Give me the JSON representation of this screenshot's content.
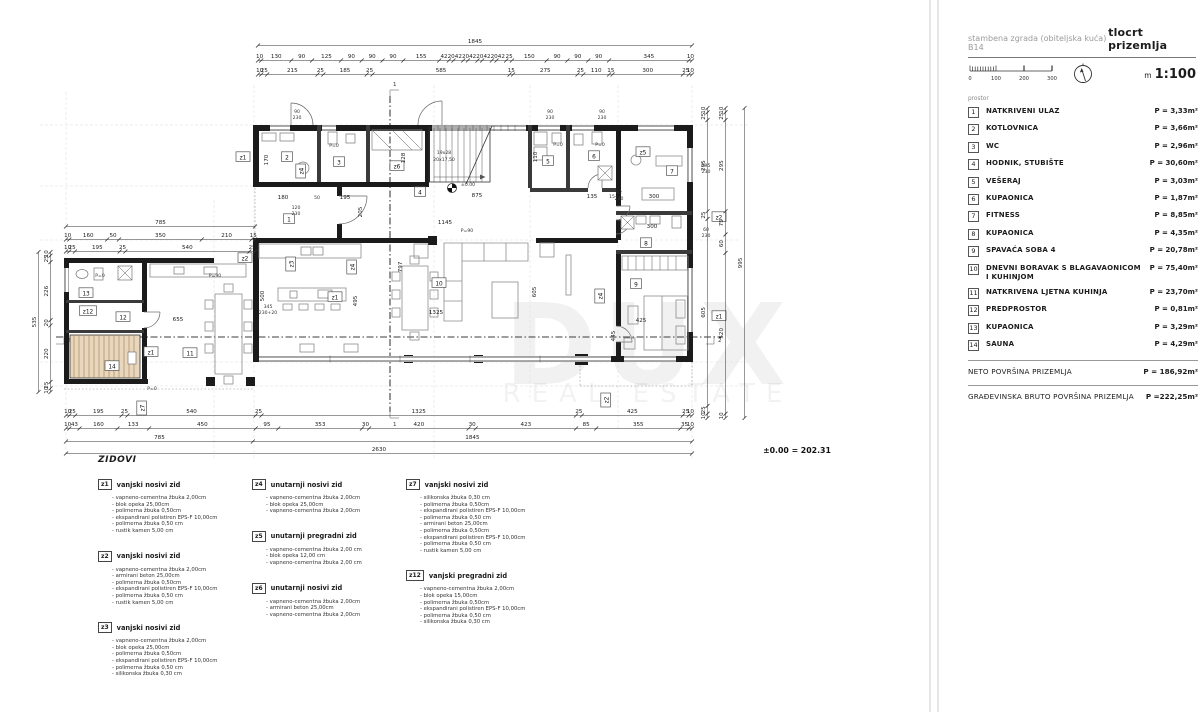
{
  "title_block": {
    "project": "stambena zgrada (obiteljska kuća) B14",
    "drawing": "tlocrt prizemlja",
    "scale_m": "m",
    "scale_value": "1:100",
    "ticks": [
      "0",
      "100",
      "200",
      "300"
    ]
  },
  "rooms": {
    "header": "prostor",
    "items": [
      {
        "num": "1",
        "name": "NATKRIVENI ULAZ",
        "area": "P = 3,33m²"
      },
      {
        "num": "2",
        "name": "KOTLOVNICA",
        "area": "P = 3,66m²"
      },
      {
        "num": "3",
        "name": "WC",
        "area": "P = 2,96m²"
      },
      {
        "num": "4",
        "name": "HODNIK, STUBIŠTE",
        "area": "P = 30,60m²"
      },
      {
        "num": "5",
        "name": "VEŠERAJ",
        "area": "P = 3,03m²"
      },
      {
        "num": "6",
        "name": "KUPAONICA",
        "area": "P = 1,87m²"
      },
      {
        "num": "7",
        "name": "FITNESS",
        "area": "P = 8,85m²"
      },
      {
        "num": "8",
        "name": "KUPAONICA",
        "area": "P = 4,35m²"
      },
      {
        "num": "9",
        "name": "SPAVAĆA SOBA 4",
        "area": "P = 20,78m²"
      },
      {
        "num": "10",
        "name": "DNEVNI BORAVAK S BLAGAVAONICOM I KUHINJOM",
        "area": "P = 75,40m²"
      },
      {
        "num": "11",
        "name": "NATKRIVENA LJETNA KUHINJA",
        "area": "P = 23,70m²"
      },
      {
        "num": "12",
        "name": "PREDPROSTOR",
        "area": "P = 0,81m²"
      },
      {
        "num": "13",
        "name": "KUPAONICA",
        "area": "P = 3,29m²"
      },
      {
        "num": "14",
        "name": "SAUNA",
        "area": "P = 4,29m²"
      }
    ],
    "neto_label": "NETO POVRŠINA PRIZEMLJA",
    "neto_area": "P = 186,92m²",
    "bruto_label": "GRAĐEVINSKA BRUTO POVRŠINA PRIZEMLJA",
    "bruto_area": "P =222,25m²"
  },
  "level_note": "±0.00 = 202.31",
  "watermark": {
    "line1": "DUX",
    "line2": "REAL ESTATE"
  },
  "walls_legend": {
    "title": "ZIDOVI",
    "items": [
      {
        "code": "z1",
        "name": "vanjski nosivi zid",
        "layers": [
          "- vapneno-cementna žbuka 2,00cm",
          "- blok opeka 25,00cm",
          "- polimerna žbuka 0,50cm",
          "- ekspandirani polistiren EPS-F 10,00cm",
          "- polimerna žbuka 0,50 cm",
          "- rustik kamen 5,00 cm"
        ]
      },
      {
        "code": "z2",
        "name": "vanjski nosivi zid",
        "layers": [
          "- vapneno-cementna žbuka 2,00cm",
          "- armirani beton 25,00cm",
          "- polimerna žbuka 0,50cm",
          "- ekspandirani polistiren EPS-F 10,00cm",
          "- polimerna žbuka 0,50 cm",
          "- rustik kamen 5,00 cm"
        ]
      },
      {
        "code": "z3",
        "name": "vanjski nosivi zid",
        "layers": [
          "- vapneno-cementna žbuka 2,00cm",
          "- blok opeka 25,00cm",
          "- polimerna žbuka 0,50cm",
          "- ekspandirani polistiren EPS-F 10,00cm",
          "- polimerna žbuka 0,50 cm",
          "- silikonska žbuka 0,30 cm"
        ]
      },
      {
        "code": "z4",
        "name": "unutarnji nosivi zid",
        "layers": [
          "- vapneno-cementna žbuka 2,00cm",
          "- blok opeka 25,00cm",
          "- vapneno-cementna žbuka 2,00cm"
        ]
      },
      {
        "code": "z5",
        "name": "unutarnji pregradni zid",
        "layers": [
          "- vapneno-cementna žbuka 2,00 cm",
          "- blok opeka 12,00 cm",
          "- vapneno-cementna žbuka 2,00 cm"
        ]
      },
      {
        "code": "z6",
        "name": "unutarnji nosivi zid",
        "layers": [
          "- vapneno-cementna žbuka 2,00cm",
          "- armirani beton 25,00cm",
          "- vapneno-cementna žbuka 2,00cm"
        ]
      },
      {
        "code": "z7",
        "name": "vanjski nosivi zid",
        "layers": [
          "- silikonska žbuka 0,30 cm",
          "- polimerna žbuka 0,50cm",
          "- ekspandirani polistiren EPS-F 10,00cm",
          "- polimerna žbuka 0,50 cm",
          "- armirani beton  25,00cm",
          "- polimerna žbuka 0,50cm",
          "- ekspandirani polistiren EPS-F 10,00cm",
          "- polimerna žbuka 0,50 cm",
          "- rustik kamen 5,00 cm"
        ]
      },
      {
        "code": "z12",
        "name": "vanjski pregradni zid",
        "layers": [
          "- vapneno-cementna žbuka 2,00cm",
          "- blok opeka 15,00cm",
          "- polimerna žbuka 0,50cm",
          "- ekspandirani polistiren EPS-F 10,00cm",
          "- polimerna žbuka 0,50 cm",
          "- silikonska žbuka 0,30 cm"
        ]
      }
    ]
  },
  "plan": {
    "section_marker": {
      "s1": "1",
      "s2": "2"
    },
    "stairs": {
      "l1": "19x28",
      "l2": "20x17,50"
    },
    "labels": {
      "d875": "875",
      "d1145": "1145",
      "d1325": "1325",
      "d655": "655",
      "d135": "135",
      "d15": "15",
      "d300": "300",
      "d180": "180",
      "d50": "50",
      "d195": "195",
      "d170": "170",
      "d128": "128",
      "d110": "110",
      "d120": "120",
      "d205": "205",
      "d230": "230",
      "d90": "90",
      "d500": "500",
      "d495": "495",
      "d797": "797",
      "d605": "605",
      "d445": "445",
      "d425": "425",
      "d345": "345",
      "d230p20": "230+20",
      "d295": "295",
      "d60": "60",
      "d92": "92",
      "p0": "P=0",
      "p90": "P=90",
      "level": "±0.00"
    },
    "dims": {
      "top_total": [
        "1845"
      ],
      "top_row_b": [
        "10",
        "130",
        "90",
        "125",
        "90",
        "90",
        "90",
        "155",
        "42",
        "20",
        "42",
        "20",
        "42",
        "20",
        "42",
        "20",
        "42",
        "25",
        "150",
        "90",
        "90",
        "90",
        "345",
        "10"
      ],
      "top_row_c": [
        "10",
        "25",
        "215",
        "25",
        "185",
        "25",
        "585",
        "15",
        "275",
        "25",
        "110",
        "15",
        "300",
        "25",
        "10"
      ],
      "wing_total": [
        "785"
      ],
      "wing_row_a": [
        "10",
        "160",
        "50",
        "350",
        "210",
        "15"
      ],
      "wing_row_b": [
        "10",
        "25",
        "195",
        "25",
        "540",
        "25"
      ],
      "left_col": [
        "10",
        "25",
        "226",
        "20",
        "220",
        "25",
        "10"
      ],
      "left_total": [
        "535"
      ],
      "right_col_1": [
        "10",
        "25",
        "295",
        "25",
        "605",
        "25",
        "10"
      ],
      "right_col_2": [
        "10",
        "25",
        "295",
        "75",
        "60",
        "520",
        "10"
      ],
      "right_total": [
        "995"
      ],
      "bottom_row_1": [
        "10",
        "25",
        "195",
        "25",
        "540",
        "25",
        "1325",
        "25",
        "425",
        "25",
        "10"
      ],
      "bottom_row_2": [
        "10",
        "43",
        "160",
        "133",
        "450",
        "95",
        "353",
        "30",
        "420",
        "30",
        "423",
        "85",
        "355",
        "35",
        "10"
      ],
      "bottom_row_3": [
        "785",
        "1845"
      ],
      "bottom_total": [
        "2630"
      ]
    }
  }
}
